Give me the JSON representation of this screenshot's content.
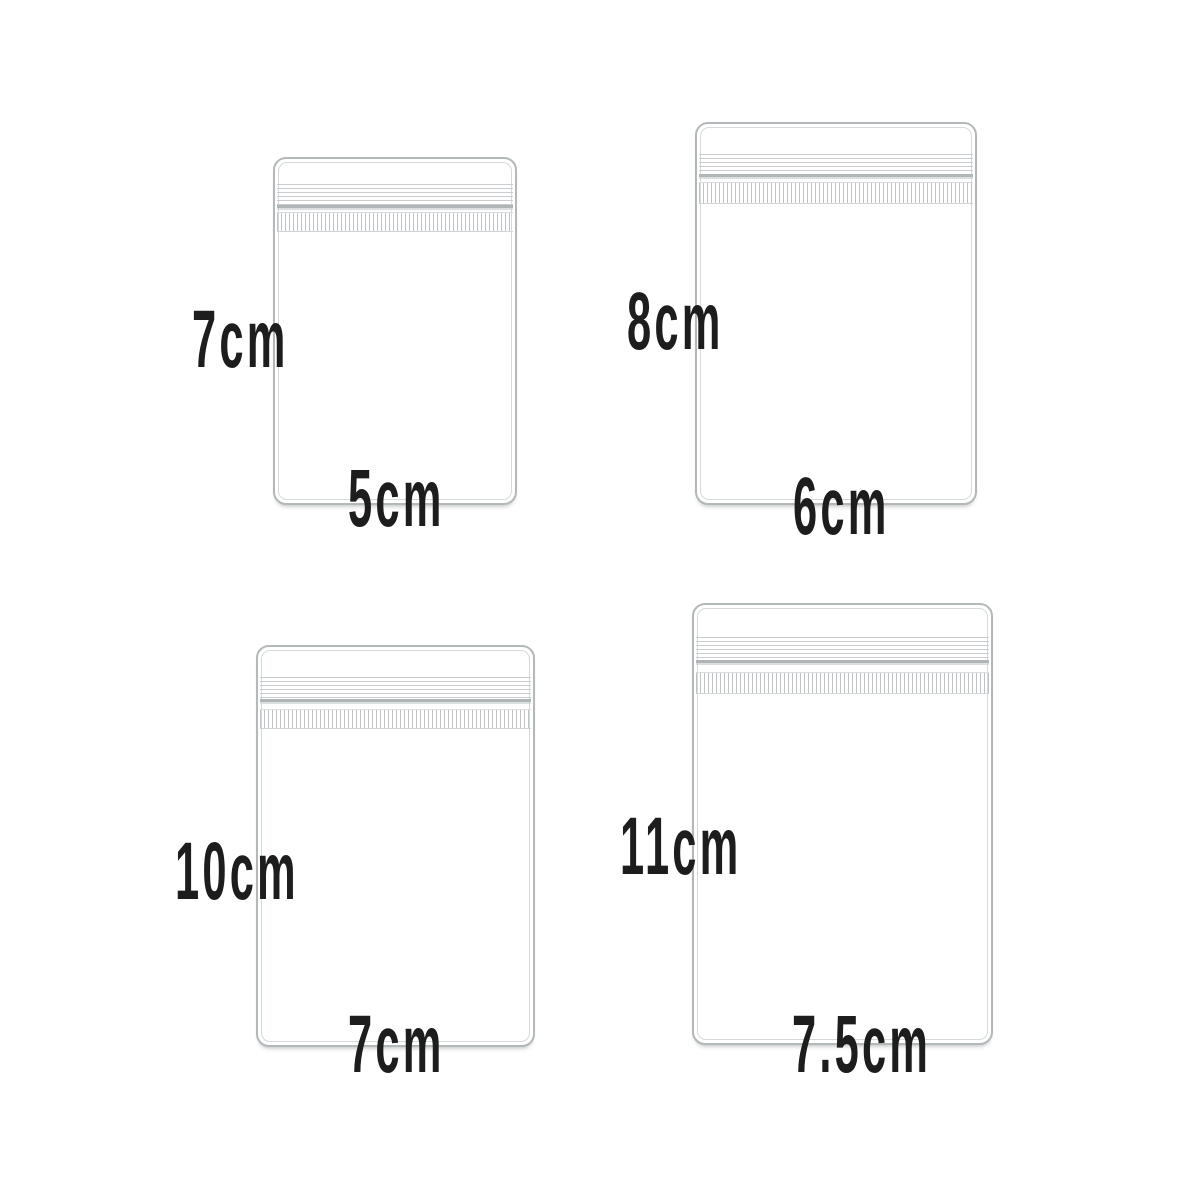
{
  "diagram": {
    "type": "product-size-diagram",
    "subject": "clear zip-lock resealable bags",
    "background_color": "#ffffff",
    "outline_color": "#b3b8ba",
    "inner_line_color": "#d6d9da",
    "label_text_color": "#1d1d1d",
    "bags": [
      {
        "position": "top-left",
        "height_label": "7cm",
        "width_label": "5cm"
      },
      {
        "position": "top-right",
        "height_label": "8cm",
        "width_label": "6cm"
      },
      {
        "position": "bottom-left",
        "height_label": "10cm",
        "width_label": "7cm"
      },
      {
        "position": "bottom-right",
        "height_label": "11cm",
        "width_label": "7.5cm"
      }
    ]
  }
}
